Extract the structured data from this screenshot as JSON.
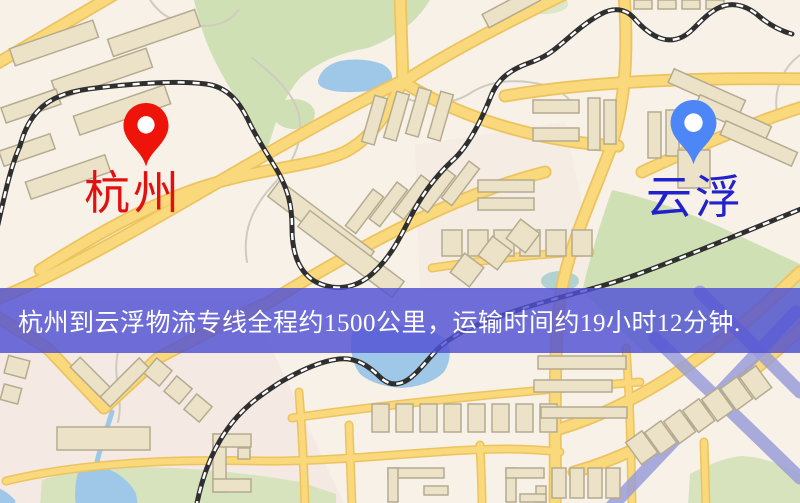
{
  "banner": {
    "text": "杭州到云浮物流专线全程约1500公里，运输时间约19小时12分钟.",
    "background_color": "#5050d4",
    "text_color": "#ffffff"
  },
  "pins": {
    "origin": {
      "label": "杭州",
      "pin_color": "#ee1409",
      "label_color": "#e31010",
      "icon": "location-pin"
    },
    "destination": {
      "label": "云浮",
      "pin_color": "#4d87f7",
      "label_color": "#2222cc",
      "icon": "location-pin"
    }
  },
  "map": {
    "colors": {
      "background": "#f7f1e8",
      "road_fill": "#f9d97b",
      "road_casing": "#edc35f",
      "railway": "#2f2f2f",
      "park": "#cfe0b4",
      "water": "#9ec7e8",
      "building_fill": "#ebe2c8",
      "building_stroke": "#b5ab8f",
      "highway": "#9a9dd8"
    }
  }
}
